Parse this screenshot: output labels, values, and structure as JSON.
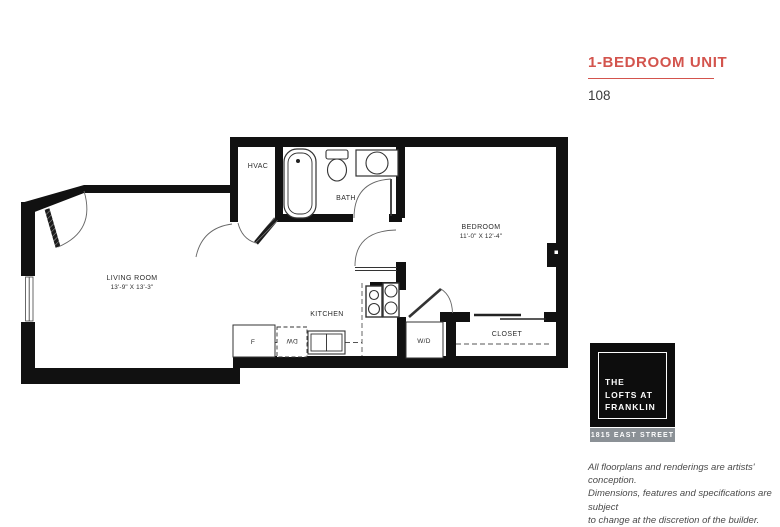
{
  "page": {
    "title": "1-BEDROOM UNIT",
    "unit_number": "108",
    "accent_color": "#d3544d"
  },
  "plan": {
    "rooms": {
      "living": {
        "name": "LIVING ROOM",
        "dims": "13'-9\" X 13'-3\""
      },
      "bedroom": {
        "name": "BEDROOM",
        "dims": "11'-0\" X 12'-4\""
      },
      "kitchen": {
        "name": "KITCHEN"
      },
      "bath": {
        "name": "BATH"
      },
      "closet": {
        "name": "CLOSET"
      },
      "hvac": {
        "name": "HVAC"
      }
    },
    "appliances": {
      "fridge": "F",
      "dishwasher": "DW",
      "washer_dryer": "W/D"
    }
  },
  "logo": {
    "line1": "THE",
    "line2": "LOFTS AT",
    "line3": "FRANKLIN",
    "address": "1815 EAST STREET",
    "square_color": "#0d0d0d",
    "bar_color": "#8b9196"
  },
  "disclaimer": {
    "line1": "All floorplans and renderings are artists' conception.",
    "line2": "Dimensions, features and specifications are subject",
    "line3": "to change at the discretion of the builder."
  }
}
